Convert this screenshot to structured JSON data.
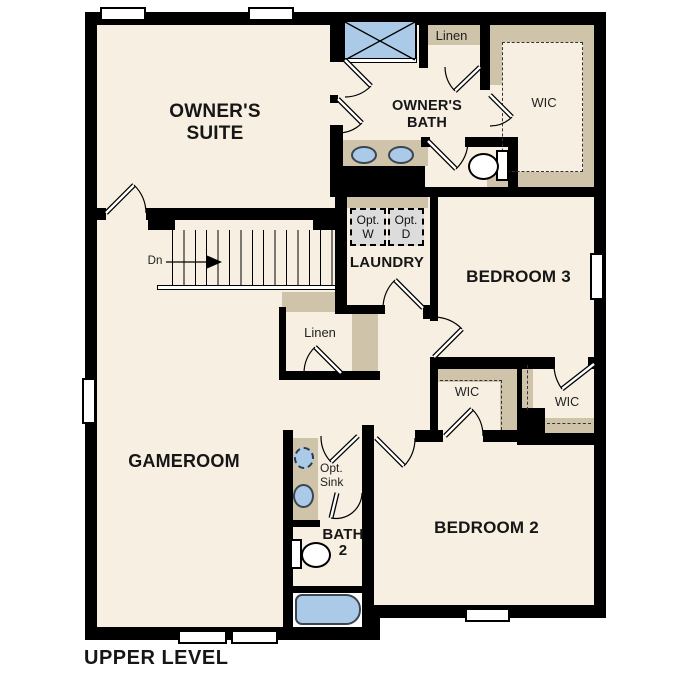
{
  "plan_title": "UPPER LEVEL",
  "rooms": {
    "owners_suite": {
      "lines": [
        "OWNER'S",
        "SUITE"
      ]
    },
    "owners_bath": {
      "lines": [
        "OWNER'S",
        "BATH"
      ]
    },
    "gameroom": {
      "label": "GAMEROOM"
    },
    "laundry": {
      "label": "LAUNDRY"
    },
    "bedroom3": {
      "label": "BEDROOM 3"
    },
    "bedroom2": {
      "label": "BEDROOM 2"
    },
    "bath2": {
      "lines": [
        "BATH",
        "2"
      ]
    },
    "wic_owners": {
      "label": "WIC"
    },
    "wic_bedroom2_left": {
      "label": "WIC"
    },
    "wic_bedroom2_right": {
      "label": "WIC"
    },
    "linen_upper": {
      "label": "Linen"
    },
    "linen_hall": {
      "label": "Linen"
    }
  },
  "annotations": {
    "stairs": {
      "label": "Dn"
    },
    "optional_washer": {
      "lines": [
        "Opt.",
        "W"
      ]
    },
    "optional_dryer": {
      "lines": [
        "Opt.",
        "D"
      ]
    },
    "optional_sink": {
      "lines": [
        "Opt.",
        "Sink"
      ]
    }
  },
  "colors": {
    "background": "#ffffff",
    "floor": "#f6efe2",
    "wall": "#000000",
    "cabinetry_tan": "#cfc3a9",
    "fixture_blue": "#abcae8",
    "optional_appliance_gray": "#dcdcdc"
  }
}
